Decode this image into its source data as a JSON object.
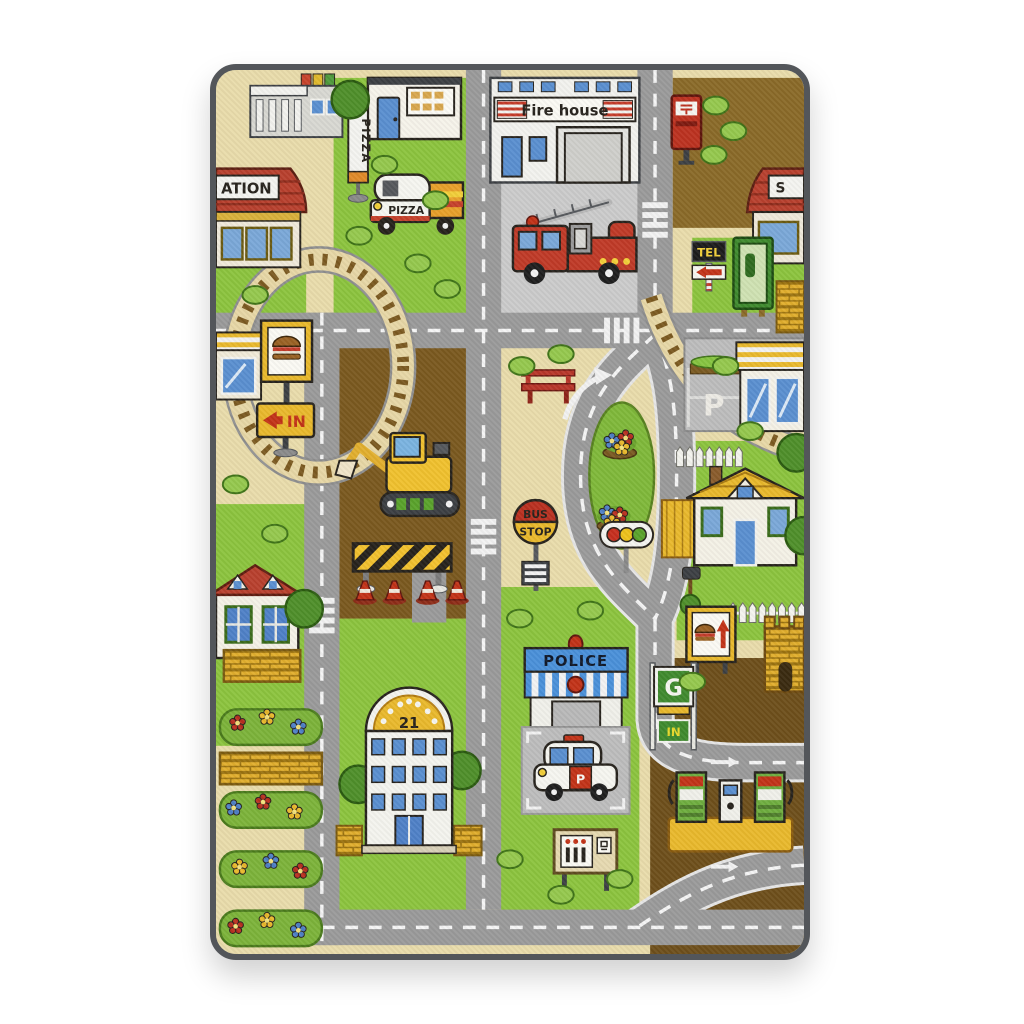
{
  "photo": {
    "labels": {
      "fire_house": "Fire house",
      "station_left": "ATION",
      "station_right": "S",
      "pizza_pole": "PIZZA",
      "pizza_truck": "PIZZA",
      "tel": "TEL",
      "parking_p": "P",
      "bus": "BUS",
      "stop": "STOP",
      "in_left": "IN",
      "police": "POLICE",
      "hotel_number": "21",
      "gas_g": "G",
      "gas_in": "IN",
      "police_car_p": "P"
    },
    "icons": {
      "postbox_symbol": "postal-mark",
      "burger_signs": "hamburger",
      "road_arrows": "direction-arrow",
      "traffic_light": "red-yellow-green"
    },
    "colors": {
      "background": "#ffffff",
      "rug_border": "#53565a",
      "sand": "#e9dcab",
      "road": "#9a9a9a",
      "grass": "#8cc43e",
      "dirt": "#7a591f",
      "courtyard": "#cbcbcb",
      "roof_red": "#b8402e",
      "accent_yellow": "#e9b92c",
      "police_blue": "#4a90d9",
      "pump_green": "#6fae3f"
    }
  }
}
